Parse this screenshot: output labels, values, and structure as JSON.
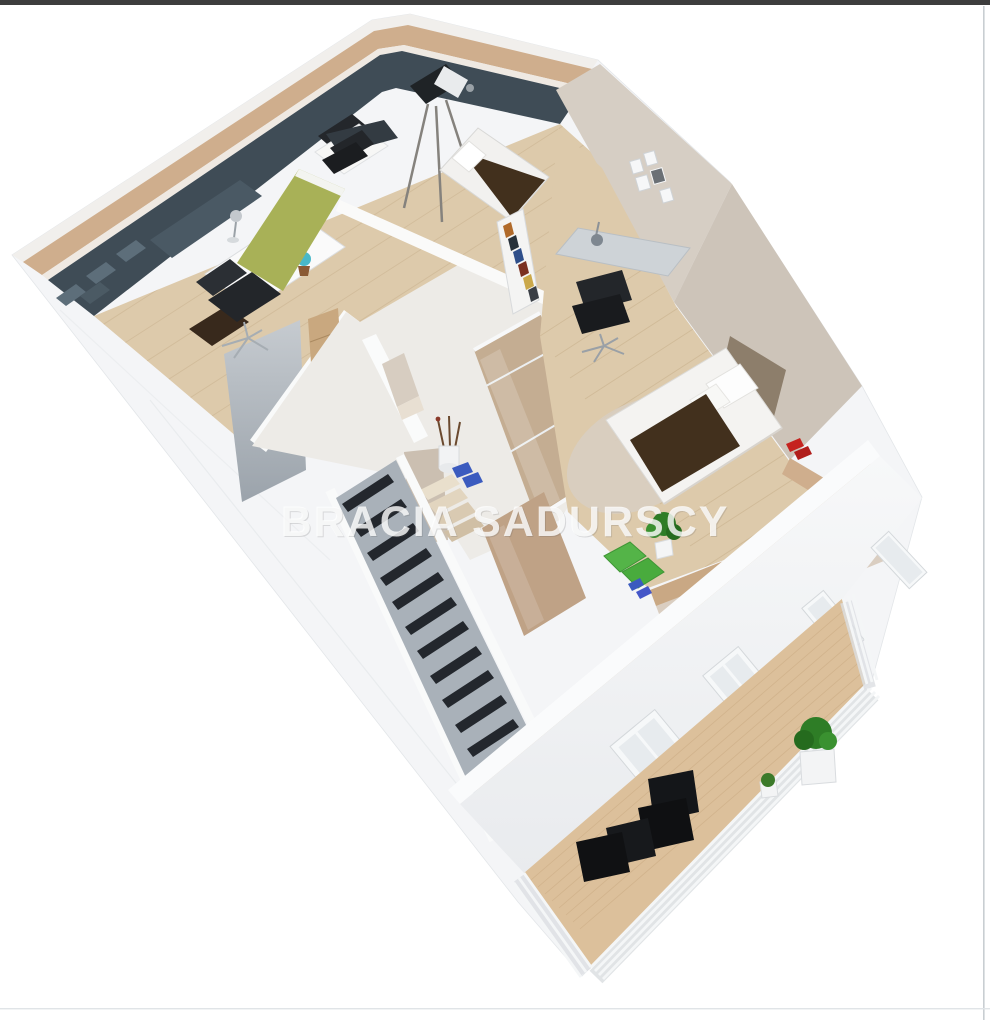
{
  "watermark": {
    "text": "BRACIA SADURSCY"
  },
  "palette": {
    "top_bar": "#3d3d3d",
    "edge_line": "#c9ced2",
    "exterior_wall": "#f4f5f7",
    "wood_trim": "#cfae8d",
    "floor_wood": "#ddcaab",
    "accent_wall_dark": "#3f4c56",
    "accent_wall_olive": "#a8b157",
    "wall_beige": "#d6cec4",
    "glass_tan": "#c4ad92",
    "stair_dark": "#23272d",
    "stair_wall": "#a9b1b9",
    "deck_wood": "#dcc09b",
    "bed_blanket": "#42301d",
    "bed_headboard": "#8d7e6b",
    "furniture_black": "#141619",
    "plant_green": "#2e7d26",
    "mat_green": "#54b448",
    "slipper_red": "#c5231f",
    "slipper_blue": "#3b5bbf",
    "rug": "#d8cec1",
    "desk_gray": "#ced3d7",
    "globe_teal": "#49b8c8",
    "watermark_color": "#ffffff"
  }
}
